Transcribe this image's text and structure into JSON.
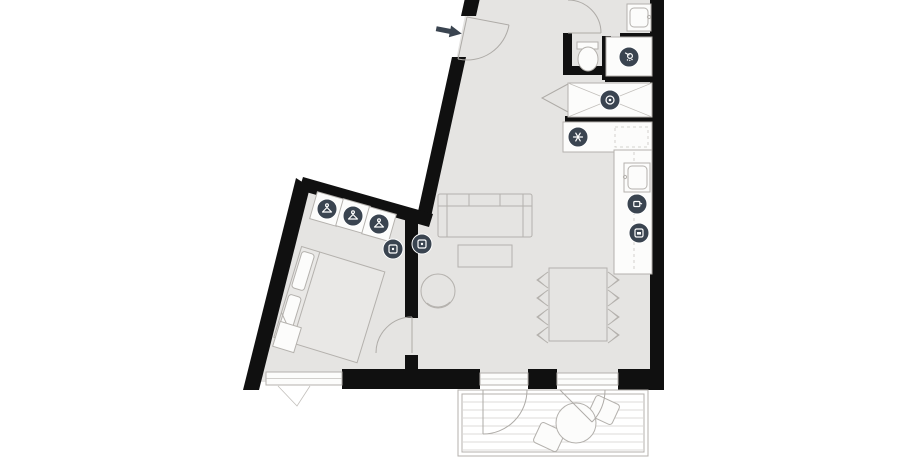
{
  "plan": {
    "kind": "apartment-floor-plan",
    "visible_text": [],
    "palette": {
      "background": "#ffffff",
      "floor": "#e5e4e2",
      "wall": "#101010",
      "furniture_fill": "#fcfcfb",
      "furniture_stroke": "#b4b1ad",
      "icon_background": "#3a4450",
      "icon_foreground": "#ffffff",
      "entrance_arrow": "#3a4450"
    },
    "entrance": {
      "arrow_symbol": "➤",
      "direction": "right-toward-door"
    },
    "icons": [
      {
        "name": "wardrobe-hanger-icon-1",
        "glyph": "hanger",
        "x": 327,
        "y": 209
      },
      {
        "name": "wardrobe-hanger-icon-2",
        "glyph": "hanger",
        "x": 353,
        "y": 216
      },
      {
        "name": "wardrobe-hanger-icon-3",
        "glyph": "hanger",
        "x": 379,
        "y": 224
      },
      {
        "name": "bedroom-device-icon",
        "glyph": "panel",
        "x": 393,
        "y": 249
      },
      {
        "name": "living-device-icon",
        "glyph": "panel",
        "x": 422,
        "y": 244
      },
      {
        "name": "shower-icon",
        "glyph": "shower",
        "x": 629,
        "y": 57
      },
      {
        "name": "washing-machine-icon",
        "glyph": "drum",
        "x": 610,
        "y": 100
      },
      {
        "name": "fridge-snowflake-icon",
        "glyph": "snow",
        "x": 578,
        "y": 137
      },
      {
        "name": "cooktop-icon",
        "glyph": "kettle",
        "x": 637,
        "y": 204
      },
      {
        "name": "oven-icon",
        "glyph": "oven",
        "x": 639,
        "y": 233
      }
    ],
    "icon_radius": 10
  }
}
